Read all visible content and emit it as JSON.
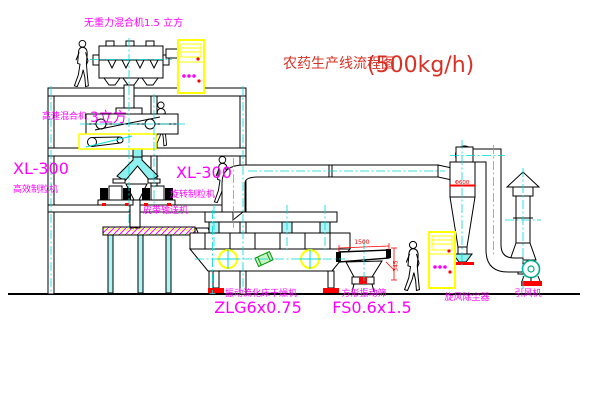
{
  "title": {
    "zh": "农药生产线流程图",
    "capacity": "(500kg/h)"
  },
  "labels": {
    "top_mixer": "无重力混合机1.5 立方",
    "floor2_mixer_name": "高速混合机",
    "floor2_mixer_size": "3立方",
    "granulator_left_model": "XL-300",
    "granulator_left_name": "高效制粒机",
    "granulator_right_model": "XL-300",
    "granulator_right_name": "旋转制粒机",
    "belt_conveyor": "皮带输送机",
    "dryer_name": "振动流化床干燥机",
    "dryer_model": "ZLG6x0.75",
    "screen_name": "方形振动筛",
    "screen_model": "FS0.6x1.5",
    "cyclone_name": "旋风除尘器",
    "fan_name": "引风机"
  },
  "dimensions": {
    "screen_length": "1500",
    "screen_height": "345",
    "cyclone_diameter": "Φ600"
  },
  "colors": {
    "label_magenta": "#ff00ff",
    "title_red": "#d93025",
    "dimension_red": "#ff0000",
    "centerline_cyan": "#00d8d8",
    "cabinet_yellow": "#ffff00",
    "line_black": "#000000"
  }
}
